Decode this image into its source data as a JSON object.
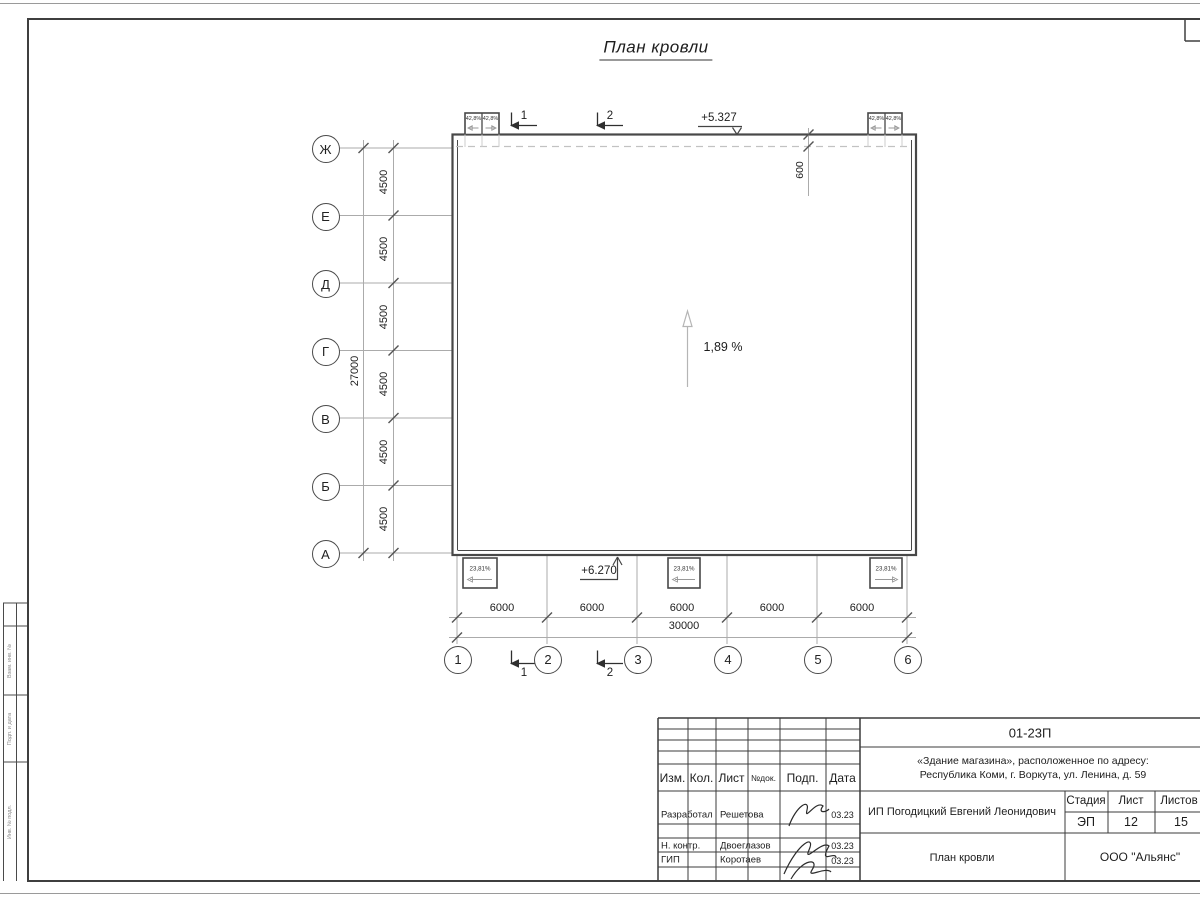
{
  "title": "План кровли",
  "axes": {
    "rows": [
      "Ж",
      "Е",
      "Д",
      "Г",
      "В",
      "Б",
      "А"
    ],
    "row_dims": [
      "4500",
      "4500",
      "4500",
      "4500",
      "4500",
      "4500"
    ],
    "row_total": "27000",
    "cols": [
      "1",
      "2",
      "3",
      "4",
      "5",
      "6"
    ],
    "col_dims": [
      "6000",
      "6000",
      "6000",
      "6000",
      "6000"
    ],
    "col_total": "30000"
  },
  "ann": {
    "elev_top": "+5.327",
    "elev_bottom": "+6.270",
    "roof_offset": "600",
    "slope_main": "1,89 %",
    "funnel_slope": "42,8%",
    "canopy_slope": "23,81%",
    "sections": [
      "1",
      "2"
    ]
  },
  "tb": {
    "doc_number": "01-23П",
    "address1": "«Здание магазина», расположенное по адресу:",
    "address2": "Республика Коми, г. Воркута, ул. Ленина, д. 59",
    "client": "ИП Погодицкий Евгений Леонидович",
    "sheet_title": "План кровли",
    "company": "ООО \"Альянс\"",
    "stage_label": "Стадия",
    "sheet_label": "Лист",
    "sheets_label": "Листов",
    "stage": "ЭП",
    "sheet": "12",
    "sheets": "15",
    "header": [
      "Изм.",
      "Кол.",
      "Лист",
      "№док.",
      "Подп.",
      "Дата"
    ],
    "rows": [
      {
        "role": "Разработал",
        "name": "Решетова",
        "date": "03.23"
      },
      {
        "role": "Н. контр.",
        "name": "Двоеглазов",
        "date": "03.23"
      },
      {
        "role": "ГИП",
        "name": "Коротаев",
        "date": "03.23"
      }
    ]
  },
  "side": [
    "Взам. инв. №",
    "Подп. и дата",
    "Инв. № подл."
  ]
}
